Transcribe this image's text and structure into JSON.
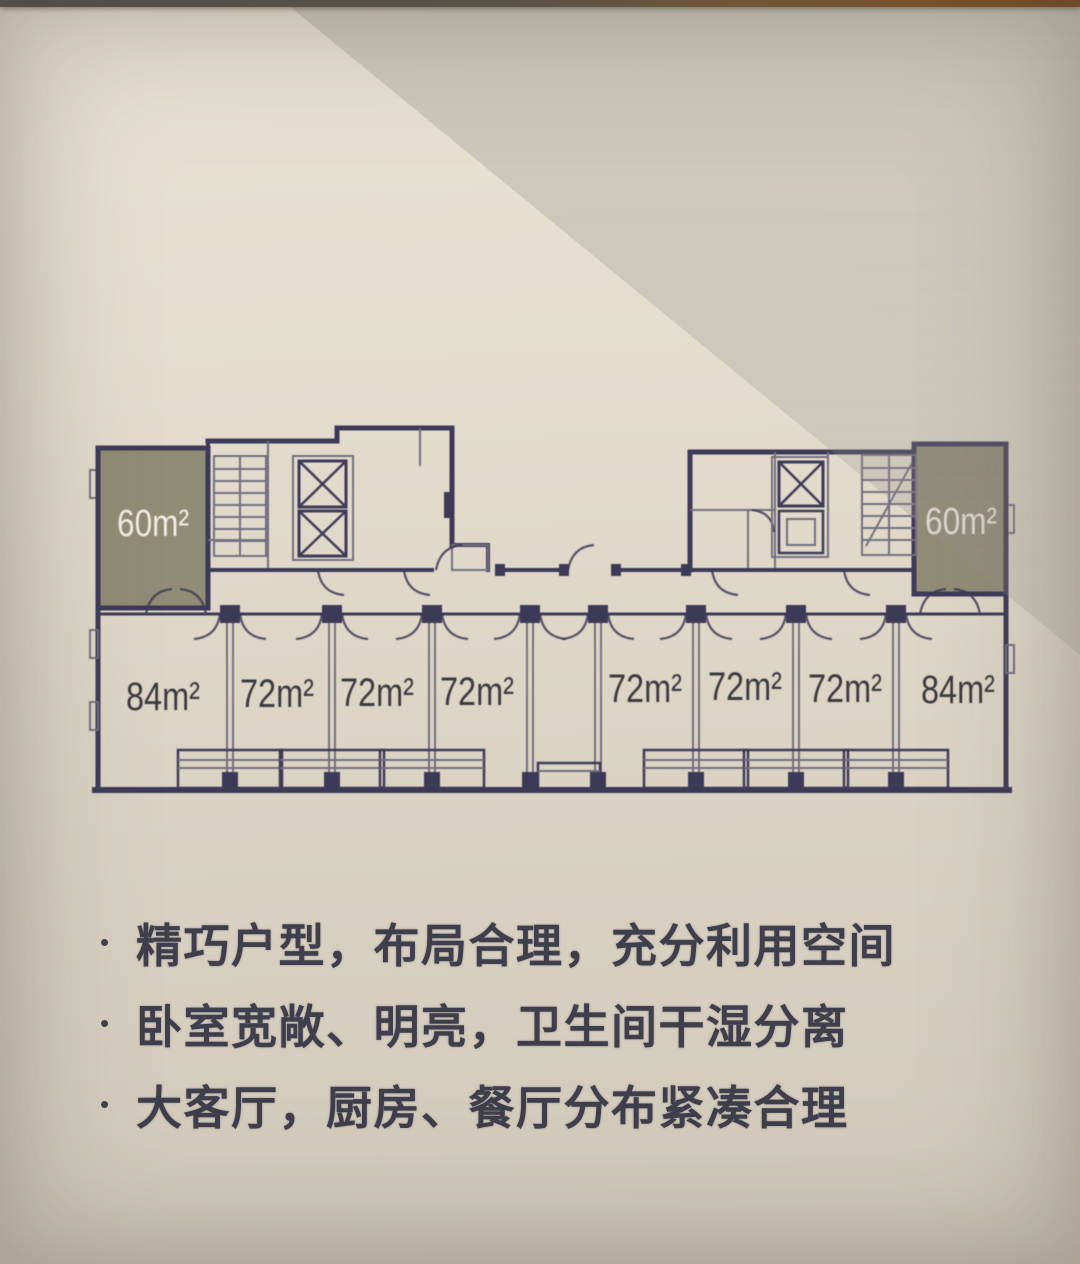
{
  "floor_plan": {
    "top_units": [
      {
        "label": "60m²"
      },
      {
        "label": "60m²"
      }
    ],
    "bottom_unit_labels": [
      "84m²",
      "72m²",
      "72m²",
      "72m²",
      "72m²",
      "72m²",
      "72m²",
      "84m²"
    ]
  },
  "features": {
    "bullet": "•",
    "items": [
      {
        "text": "精巧户型，布局合理，充分利用空间"
      },
      {
        "text": "卧室宽敞、明亮，卫生间干湿分离"
      },
      {
        "text": "大客厅，厨房、餐厅分布紧凑合理"
      }
    ]
  },
  "colors": {
    "wall": "#373453",
    "partition": "#6f6c7c",
    "unit_60_fill": "#8d8973",
    "unit_60_label": "#f2efe5",
    "area_label": "#35343a",
    "feature_text": "#3f3e4b",
    "paper_light": "#e7e0d1",
    "paper_shade": "#d0cac0",
    "photo_edge_left": "#514d47",
    "photo_edge_right": "#6b4a28"
  }
}
